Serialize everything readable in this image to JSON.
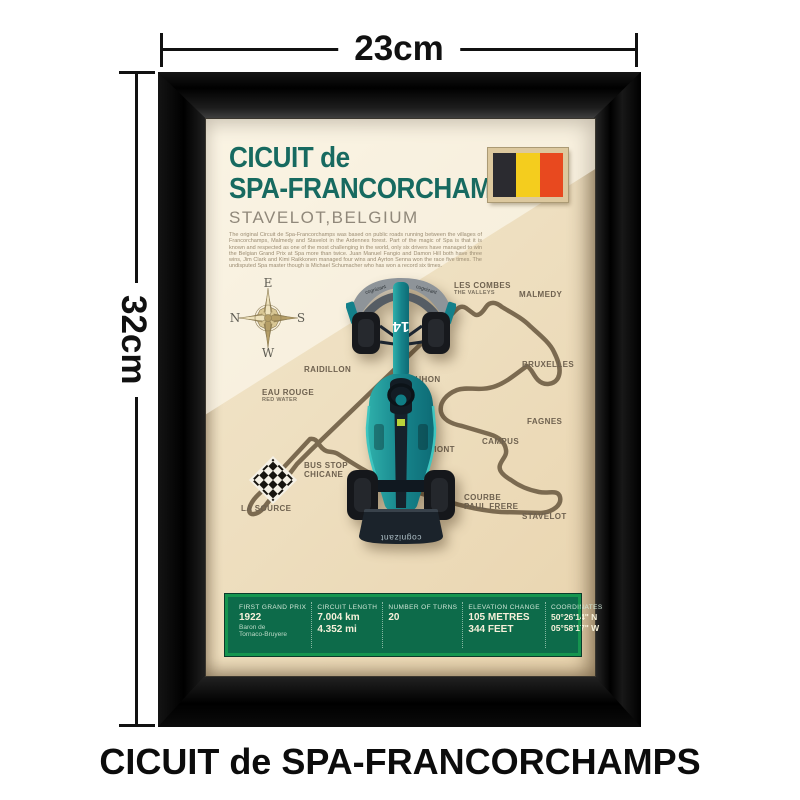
{
  "annotations": {
    "width_label": "23cm",
    "height_label": "32cm",
    "caption": "CICUIT de SPA-FRANCORCHAMPS"
  },
  "poster": {
    "title_line1": "CICUIT de",
    "title_line2": "SPA-FRANCORCHAMPS",
    "subtitle": "STAVELOT,BELGIUM",
    "description": "The original Circuit de Spa-Francorchamps was based on public roads running between the villages of Francorchamps, Malmedy and Stavelot in the Ardennes forest. Part of the magic of Spa is that it is known and respected as one of the most challenging in the world, only six drivers have managed to win the Belgian Grand Prix at Spa more than twice. Juan Manuel Fangio and Damon Hill both have three wins, Jim Clark and Kimi Raikkonen managed four wins and Ayrton Senna won the race five times. The undisputed Spa master though is Michael Schumacher who has won a record six times.",
    "flag": {
      "name": "belgium-flag",
      "colors": [
        "#2b2b30",
        "#f4cd1e",
        "#e8491f"
      ]
    },
    "compass": {
      "top": "E",
      "left": "N",
      "right": "S",
      "bottom": "W"
    },
    "car": {
      "number": "14",
      "sponsor_front": "cognizant",
      "sponsor_rear": "cognizant",
      "team_color": "#17858c"
    },
    "map": {
      "track_color": "#7b6a50",
      "labels": [
        {
          "lines": [
            "LES COMBES"
          ],
          "sub": "THE VALLEYS",
          "x": 248,
          "y": 162
        },
        {
          "lines": [
            "MALMEDY"
          ],
          "x": 313,
          "y": 171
        },
        {
          "lines": [
            "BRUXELLES"
          ],
          "x": 316,
          "y": 241
        },
        {
          "lines": [
            "FAGNES"
          ],
          "x": 321,
          "y": 298
        },
        {
          "lines": [
            "CAMPUS"
          ],
          "x": 276,
          "y": 318
        },
        {
          "lines": [
            "POUHON"
          ],
          "x": 197,
          "y": 256
        },
        {
          "lines": [
            "BLANCHIMONT"
          ],
          "x": 185,
          "y": 326
        },
        {
          "lines": [
            "RAIDILLON"
          ],
          "x": 98,
          "y": 246
        },
        {
          "lines": [
            "EAU ROUGE"
          ],
          "sub": "RED WATER",
          "x": 56,
          "y": 269
        },
        {
          "lines": [
            "BUS STOP",
            "CHICANE"
          ],
          "x": 98,
          "y": 342
        },
        {
          "lines": [
            "LA SOURCE"
          ],
          "x": 35,
          "y": 385
        },
        {
          "lines": [
            "COURBE",
            "PAUL FRERE"
          ],
          "x": 258,
          "y": 374
        },
        {
          "lines": [
            "STAVELOT"
          ],
          "x": 316,
          "y": 393
        }
      ]
    },
    "stats": [
      {
        "label": "FIRST GRAND PRIX",
        "values": [
          "1922"
        ],
        "subs": [
          "Baron de",
          "Tornaco-Bruyere"
        ]
      },
      {
        "label": "CIRCUIT LENGTH",
        "values": [
          "7.004 km",
          "4.352 mi"
        ],
        "subs": []
      },
      {
        "label": "NUMBER OF TURNS",
        "values": [
          "20"
        ],
        "subs": []
      },
      {
        "label": "ELEVATION CHANGE",
        "values": [
          "105 METRES",
          "344 FEET"
        ],
        "subs": []
      },
      {
        "label": "COORDINATES",
        "values": [
          "50°26'14\" N",
          "05°58'17\" W"
        ],
        "subs": []
      }
    ]
  }
}
